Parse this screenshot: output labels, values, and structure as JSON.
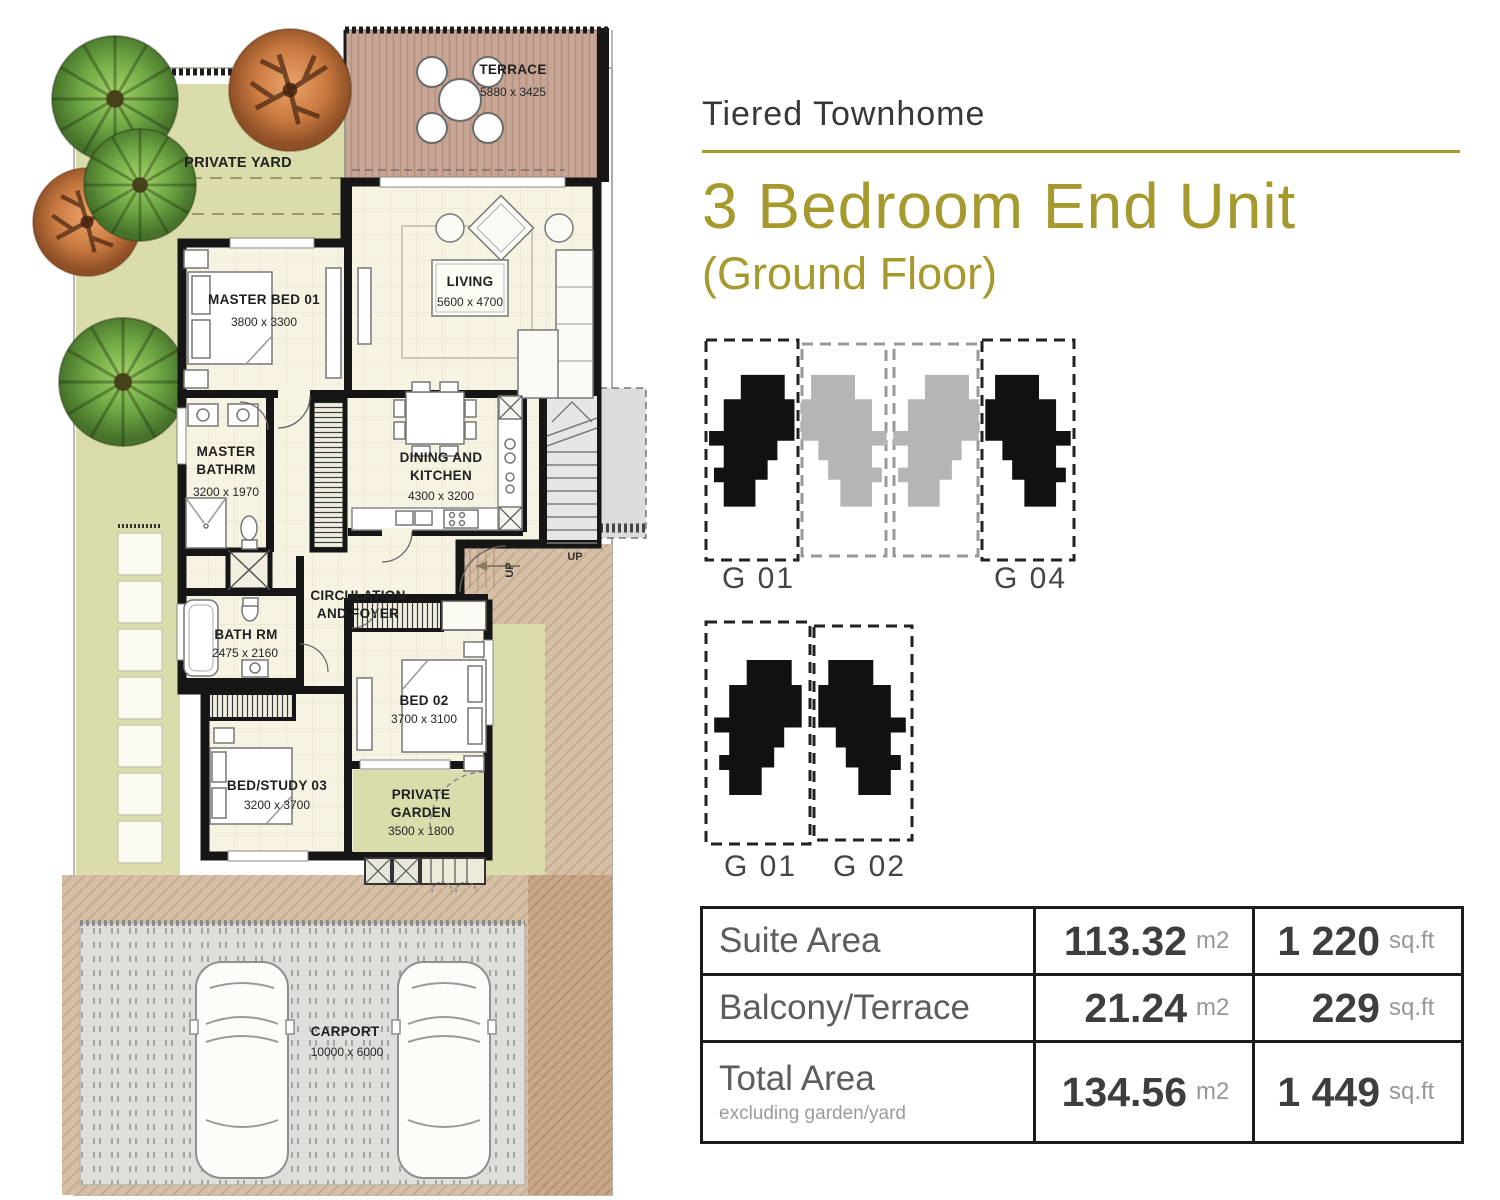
{
  "header": {
    "subtitle": "Tiered Townhome",
    "title": "3 Bedroom End Unit",
    "title2": "(Ground Floor)"
  },
  "plan": {
    "terrace": {
      "name": "TERRACE",
      "dims": "5880 x 3425"
    },
    "private_yard": {
      "name": "PRIVATE YARD"
    },
    "master_bed": {
      "name": "MASTER BED 01",
      "dims": "3800 x 3300"
    },
    "living": {
      "name": "LIVING",
      "dims": "5600 x 4700"
    },
    "master_bath": {
      "line1": "MASTER",
      "line2": "BATHRM",
      "dims": "3200 x 1970"
    },
    "dining": {
      "line1": "DINING AND",
      "line2": "KITCHEN",
      "dims": "4300 x 3200"
    },
    "circulation": {
      "line1": "CIRCULATION",
      "line2": "AND FOYER"
    },
    "bath": {
      "name": "BATH RM",
      "dims": "2475 x 2160"
    },
    "bed2": {
      "name": "BED 02",
      "dims": "3700 x 3100"
    },
    "bed3": {
      "name": "BED/STUDY 03",
      "dims": "3200 x 3700"
    },
    "garden": {
      "line1": "PRIVATE",
      "line2": "GARDEN",
      "dims": "3500 x 1800"
    },
    "carport": {
      "name": "CARPORT",
      "dims": "10000 x 6000"
    },
    "stairs_up": "UP",
    "entry_up": "UP"
  },
  "diagrams": {
    "row1": {
      "left": "G 01",
      "right": "G 04"
    },
    "row2": {
      "left": "G 01",
      "right": "G 02"
    }
  },
  "table": {
    "rows": [
      {
        "label": "Suite Area",
        "m2": "113.32",
        "m2_unit": "m2",
        "sqft": "1 220",
        "sqft_unit": "sq.ft"
      },
      {
        "label": "Balcony/Terrace",
        "m2": "21.24",
        "m2_unit": "m2",
        "sqft": "229",
        "sqft_unit": "sq.ft"
      },
      {
        "label": "Total Area",
        "note": "excluding garden/yard",
        "m2": "134.56",
        "m2_unit": "m2",
        "sqft": "1 449",
        "sqft_unit": "sq.ft"
      }
    ]
  },
  "colors": {
    "accent": "#a6992d",
    "wall": "#161616",
    "yard_green": "#dadcab",
    "deck_wood": "#c8a695",
    "carport_pad": "#dfdedb",
    "tan": "#d5bfa6"
  }
}
